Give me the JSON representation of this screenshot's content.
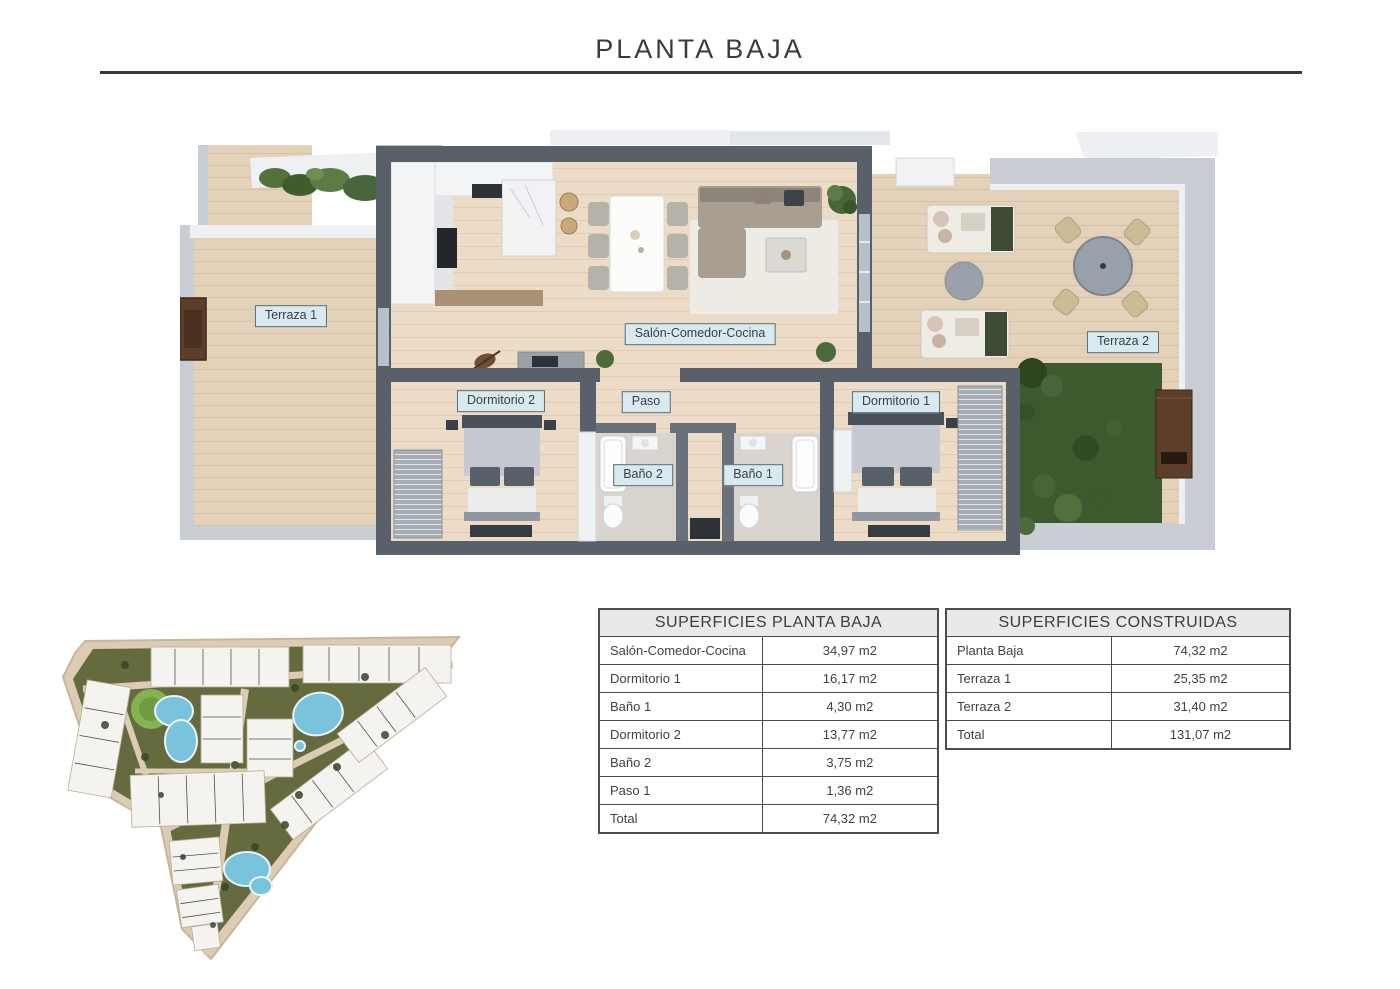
{
  "page": {
    "title": "PLANTA BAJA"
  },
  "floor_plan": {
    "labels": {
      "terraza_1": "Terraza 1",
      "salon": "Salón-Comedor-Cocina",
      "terraza_2": "Terraza 2",
      "dormitorio_2": "Dormitorio 2",
      "paso": "Paso",
      "dormitorio_1": "Dormitorio 1",
      "bano_2": "Baño 2",
      "bano_1": "Baño 1"
    },
    "colors": {
      "wall": "#596069",
      "wood_floor": "#ecdcc7",
      "terrace_floor": "#e3d1ba",
      "label_bg": "#d8eaef",
      "lawn": "#3d592e",
      "pool": "#79c3dd"
    }
  },
  "tables": [
    {
      "title": "SUPERFICIES PLANTA BAJA",
      "rows": [
        {
          "label": "Salón-Comedor-Cocina",
          "value": "34,97 m2"
        },
        {
          "label": "Dormitorio 1",
          "value": "16,17 m2"
        },
        {
          "label": "Baño 1",
          "value": "4,30 m2"
        },
        {
          "label": "Dormitorio 2",
          "value": "13,77 m2"
        },
        {
          "label": "Baño 2",
          "value": "3,75 m2"
        },
        {
          "label": "Paso 1",
          "value": "1,36 m2"
        },
        {
          "label": "Total",
          "value": "74,32 m2"
        }
      ]
    },
    {
      "title": "SUPERFICIES CONSTRUIDAS",
      "rows": [
        {
          "label": "Planta Baja",
          "value": "74,32 m2"
        },
        {
          "label": "Terraza 1",
          "value": "25,35 m2"
        },
        {
          "label": "Terraza 2",
          "value": "31,40 m2"
        },
        {
          "label": "Total",
          "value": "131,07 m2"
        }
      ]
    }
  ]
}
